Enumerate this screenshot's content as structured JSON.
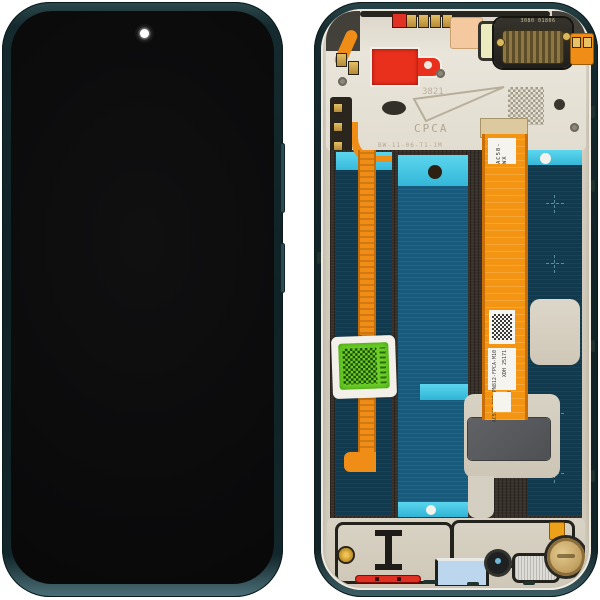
{
  "photo": {
    "subject": "Smartphone LCD display assembly spare part shown from front and back",
    "front_view": "Assembled front: black display panel in dark teal frame with punch-hole camera",
    "back_view": "Rear of display module: metal shield plates, adhesive panels, flex cables, stickers"
  },
  "colors": {
    "background": "#ffffff",
    "frame_teal": "#16292d",
    "screen_black": "#0a0a0b",
    "metal_plate": "#d6cfc0",
    "adhesive_teal": "#123a4e",
    "tape_cyan": "#45cbe8",
    "flex_orange": "#f29213",
    "pull_tab_red": "#e8301d",
    "sticker_green": "#6ccf27",
    "motor_gold": "#c5a465"
  },
  "markings": {
    "earpiece_line1": "3080",
    "earpiece_line2": "01806",
    "etched_number": "3821",
    "etched_brand": "CPCA",
    "etched_serial": "BW-11-06-T1-1M",
    "left_flex_code": "JC51B AZ 8537",
    "center_flex_label": "AC58-WX",
    "center_flex_code1": "BW68010-M00-X001",
    "center_flex_code2": "AC51B-BOE PN812-FPCA-M10",
    "center_flex_code3": "XDH 25171"
  }
}
